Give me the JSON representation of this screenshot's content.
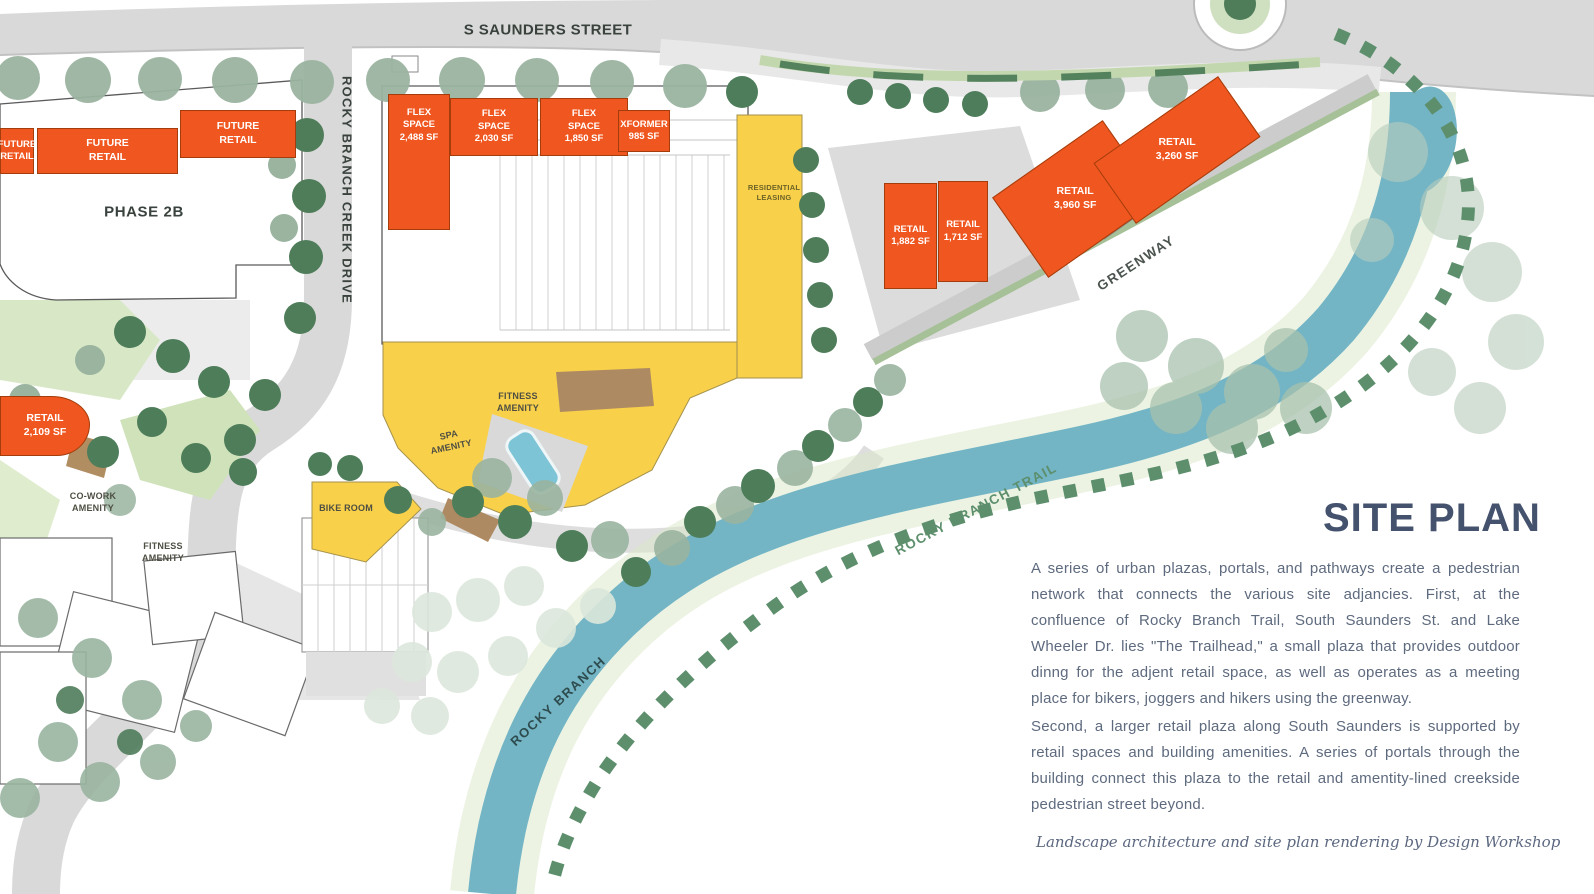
{
  "colors": {
    "orange_building": "#f0561f",
    "yellow_amenity": "#f8d04a",
    "river": "#73b5c5",
    "road_gray": "#d9d9d9",
    "tree_dark": "#4e7d5b",
    "tree_sage": "#9ab4a0",
    "trail_green": "#5d8f6d",
    "heading_text": "#44526e",
    "body_text": "#5e6a7e",
    "map_label_text": "#39423c"
  },
  "streets": {
    "s_saunders": "S SAUNDERS STREET",
    "rocky_branch_creek_drive": "ROCKY BRANCH CREEK DRIVE",
    "greenway": "GREENWAY",
    "rocky_branch_trail": "ROCKY BRANCH TRAIL",
    "rocky_branch": "ROCKY BRANCH"
  },
  "areas": {
    "phase_2b": "PHASE 2B",
    "residential_leasing": "RESIDENTIAL\nLEASING",
    "co_work": "CO-WORK\nAMENITY",
    "fitness_left": "FITNESS\nAMENITY",
    "fitness_center": "FITNESS\nAMENITY",
    "spa": "SPA\nAMENITY",
    "bike_room": "BIKE ROOM"
  },
  "buildings": {
    "future_retail_1": "FUTURE\nRETAIL",
    "future_retail_2": "FUTURE\nRETAIL",
    "future_retail_3": "FUTURE\nRETAIL",
    "flex_1": "FLEX\nSPACE\n2,488 SF",
    "flex_2": "FLEX\nSPACE\n2,030 SF",
    "flex_3": "FLEX\nSPACE\n1,850 SF",
    "xformer": "XFORMER\n985 SF",
    "retail_1882": "RETAIL\n1,882 SF",
    "retail_1712": "RETAIL\n1,712 SF",
    "retail_3960": "RETAIL\n3,960 SF",
    "retail_3260": "RETAIL\n3,260 SF",
    "retail_2109": "RETAIL\n2,109 SF"
  },
  "panel": {
    "title": "SITE PLAN",
    "paragraph_1": "A series of urban plazas, portals, and pathways create a pedestrian network that connects the various site adjancies. First, at the confluence of Rocky Branch Trail, South Saunders St. and Lake Wheeler Dr. lies \"The Trailhead,\" a small plaza that provides outdoor dinng for the adjent retail space, as well as operates as a meeting place for bikers, joggers and hikers using the greenway.",
    "paragraph_2": "Second, a larger retail plaza along South Saunders is supported by retail spaces and building amenities. A series of portals through the building connect this plaza to the retail and amentity-lined creekside pedestrian street beyond.",
    "credit": "Landscape architecture and site plan rendering by Design Workshop"
  }
}
